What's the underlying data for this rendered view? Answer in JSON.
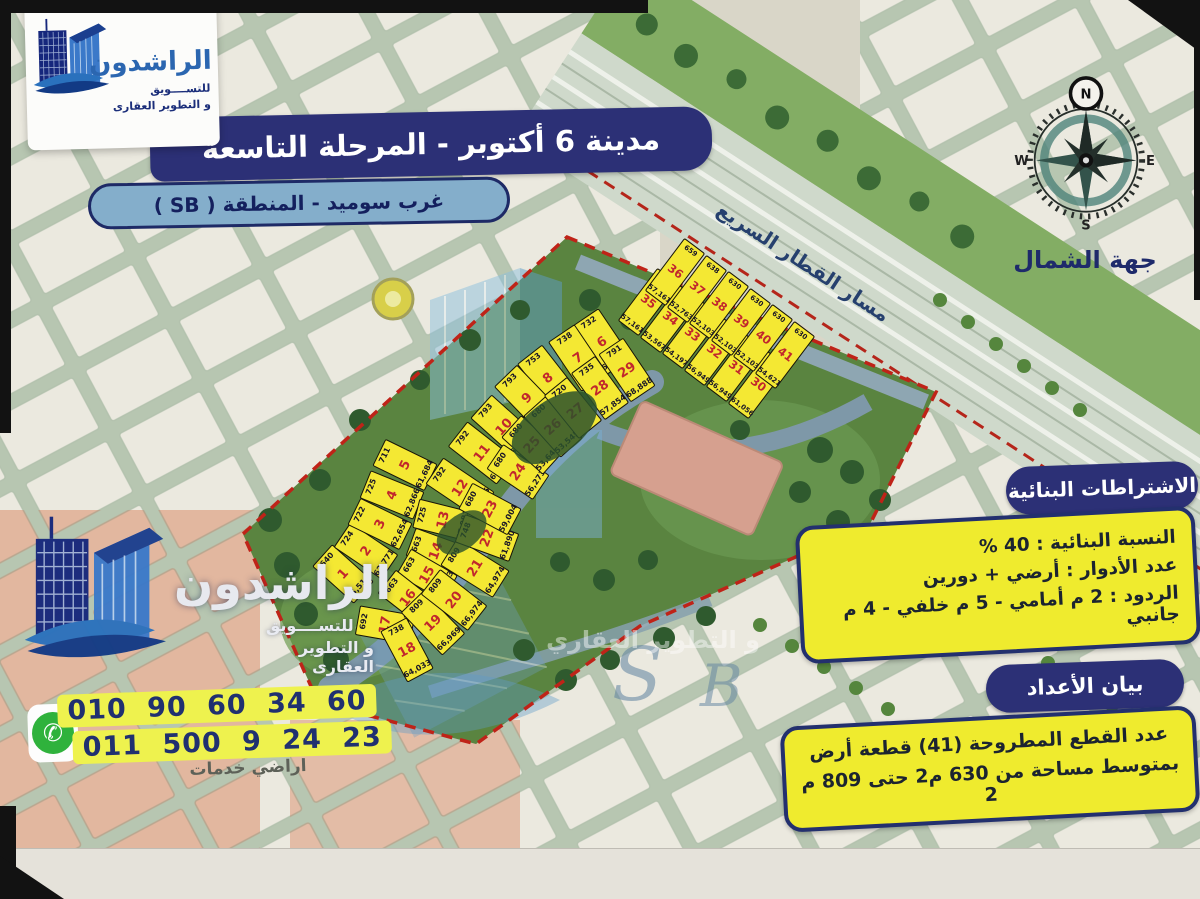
{
  "header": {
    "title": "مدينة 6 أكتوبر - المرحلة التاسعة",
    "subtitle": "غرب سوميد - المنطقة ( SB )"
  },
  "brand": {
    "name": "الراشدون",
    "tagline1": "للتســــويق",
    "tagline2": "و التطوير العقارى"
  },
  "compass": {
    "label": "جهة الشمال",
    "n": "N",
    "s": "S",
    "e": "E",
    "w": "W"
  },
  "requirements": {
    "header": "الاشتراطات البنائية",
    "lines": [
      "النسبة البنائية : 40 %",
      "عدد الأدوار :  أرضي + دورين",
      "الردود : 2 م أمامي - 5 م خلفي - 4 م جانبي"
    ]
  },
  "counts": {
    "header": "بيان الأعداد",
    "lines": [
      "عدد القطع المطروحة (41) قطعة أرض",
      "بمتوسط مساحة من 630 م2 حتى 809 م 2"
    ]
  },
  "contact": {
    "phone1": "010 90 60 34 60",
    "phone2": "011 500 9 24 23"
  },
  "map": {
    "rail_label": "مسار القطار السريع",
    "services_label": "اراضي خدمات",
    "watermark_s": "S",
    "watermark_b": "B",
    "watermark_phrase": "و التطوير العقاري",
    "plots": [
      {
        "n": "1",
        "area": "640",
        "price": "55,510",
        "x": 343,
        "y": 574,
        "r": -48,
        "w": 30,
        "h": 56,
        "g": "b"
      },
      {
        "n": "2",
        "area": "724",
        "price": "62,771",
        "x": 366,
        "y": 551,
        "r": -56,
        "w": 30,
        "h": 58,
        "g": "b"
      },
      {
        "n": "3",
        "area": "722",
        "price": "62,654",
        "x": 380,
        "y": 524,
        "r": -64,
        "w": 30,
        "h": 58,
        "g": "b"
      },
      {
        "n": "4",
        "area": "725",
        "price": "62,866",
        "x": 392,
        "y": 495,
        "r": -68,
        "w": 30,
        "h": 58,
        "g": "b"
      },
      {
        "n": "5",
        "area": "711",
        "price": "61,684",
        "x": 405,
        "y": 465,
        "r": -64,
        "w": 30,
        "h": 58,
        "g": "b"
      },
      {
        "n": "6",
        "area": "732",
        "price": "63,508",
        "x": 602,
        "y": 342,
        "r": -34,
        "w": 32,
        "h": 60,
        "g": "b"
      },
      {
        "n": "7",
        "area": "738",
        "price": "61,056",
        "x": 578,
        "y": 358,
        "r": -34,
        "w": 32,
        "h": 60,
        "g": "b"
      },
      {
        "n": "8",
        "area": "753",
        "price": "62,298",
        "x": 548,
        "y": 378,
        "r": -38,
        "w": 32,
        "h": 60,
        "g": "b"
      },
      {
        "n": "9",
        "area": "793",
        "price": "65,582",
        "x": 527,
        "y": 398,
        "r": -44,
        "w": 32,
        "h": 62,
        "g": "b"
      },
      {
        "n": "10",
        "area": "793",
        "price": "65,579",
        "x": 504,
        "y": 427,
        "r": -48,
        "w": 32,
        "h": 62,
        "g": "b"
      },
      {
        "n": "11",
        "area": "792",
        "price": "68,745",
        "x": 482,
        "y": 453,
        "r": -52,
        "w": 32,
        "h": 62,
        "g": "b"
      },
      {
        "n": "12",
        "area": "792",
        "price": "65,565",
        "x": 460,
        "y": 488,
        "r": -56,
        "w": 32,
        "h": 62,
        "g": "b"
      },
      {
        "n": "13",
        "area": "725",
        "price": "57,081",
        "x": 443,
        "y": 520,
        "r": -76,
        "w": 30,
        "h": 56,
        "g": "b"
      },
      {
        "n": "14",
        "area": "663",
        "price": "52,215",
        "x": 436,
        "y": 551,
        "r": -70,
        "w": 30,
        "h": 54,
        "g": "b"
      },
      {
        "n": "15",
        "area": "663",
        "price": "52,223",
        "x": 427,
        "y": 575,
        "r": -60,
        "w": 30,
        "h": 54,
        "g": "b"
      },
      {
        "n": "16",
        "area": "663",
        "price": "52,227",
        "x": 408,
        "y": 598,
        "r": -52,
        "w": 30,
        "h": 54,
        "g": "b"
      },
      {
        "n": "17",
        "area": "692",
        "price": "57,285",
        "x": 385,
        "y": 625,
        "r": -80,
        "w": 30,
        "h": 56,
        "g": "b"
      },
      {
        "n": "18",
        "area": "738",
        "price": "64,033",
        "x": 407,
        "y": 650,
        "r": -28,
        "w": 30,
        "h": 58,
        "g": "b"
      },
      {
        "n": "19",
        "area": "809",
        "price": "66,969",
        "x": 433,
        "y": 623,
        "r": -44,
        "w": 32,
        "h": 60,
        "g": "b"
      },
      {
        "n": "20",
        "area": "809",
        "price": "66,974",
        "x": 454,
        "y": 600,
        "r": -52,
        "w": 32,
        "h": 60,
        "g": "b"
      },
      {
        "n": "21",
        "area": "809",
        "price": "64,974",
        "x": 475,
        "y": 568,
        "r": -58,
        "w": 32,
        "h": 62,
        "g": "b"
      },
      {
        "n": "22",
        "area": "748",
        "price": "61,890",
        "x": 487,
        "y": 538,
        "r": -70,
        "w": 30,
        "h": 58,
        "g": "b"
      },
      {
        "n": "23",
        "area": "680",
        "price": "59,004",
        "x": 490,
        "y": 509,
        "r": -62,
        "w": 30,
        "h": 56,
        "g": "b"
      },
      {
        "n": "24",
        "area": "680",
        "price": "56,273",
        "x": 518,
        "y": 472,
        "r": -56,
        "w": 30,
        "h": 56,
        "g": "b"
      },
      {
        "n": "25",
        "area": "680",
        "price": "53,646",
        "x": 532,
        "y": 445,
        "r": -48,
        "w": 30,
        "h": 56,
        "g": "b"
      },
      {
        "n": "26",
        "area": "680",
        "price": "53,545",
        "x": 553,
        "y": 427,
        "r": -42,
        "w": 30,
        "h": 56,
        "g": "b"
      },
      {
        "n": "27",
        "area": "720",
        "price": "",
        "x": 573,
        "y": 408,
        "r": -39,
        "w": 30,
        "h": 56,
        "g": "b"
      },
      {
        "n": "28",
        "area": "735",
        "price": "57,854",
        "x": 600,
        "y": 388,
        "r": -36,
        "w": 30,
        "h": 58,
        "g": "b"
      },
      {
        "n": "29",
        "area": "791",
        "price": "68,888",
        "x": 627,
        "y": 370,
        "r": -34,
        "w": 30,
        "h": 58,
        "g": "b"
      },
      {
        "n": "30",
        "area": "738",
        "price": "61,056",
        "x": 758,
        "y": 385,
        "r": 37,
        "w": 26,
        "h": 66,
        "g": "a"
      },
      {
        "n": "31",
        "area": "688",
        "price": "56,949",
        "x": 736,
        "y": 368,
        "r": 37,
        "w": 26,
        "h": 66,
        "g": "a"
      },
      {
        "n": "32",
        "area": "688",
        "price": "56,949",
        "x": 714,
        "y": 352,
        "r": 37,
        "w": 26,
        "h": 66,
        "g": "a"
      },
      {
        "n": "33",
        "area": "688",
        "price": "54,197",
        "x": 692,
        "y": 335,
        "r": 37,
        "w": 26,
        "h": 66,
        "g": "a"
      },
      {
        "n": "34",
        "area": "680",
        "price": "53,567",
        "x": 670,
        "y": 319,
        "r": 37,
        "w": 26,
        "h": 66,
        "g": "a"
      },
      {
        "n": "35",
        "area": "659",
        "price": "57,161",
        "x": 648,
        "y": 302,
        "r": 37,
        "w": 26,
        "h": 66,
        "g": "a"
      },
      {
        "n": "36",
        "area": "659",
        "price": "57,161",
        "x": 675,
        "y": 272,
        "r": 37,
        "w": 26,
        "h": 66,
        "g": "a"
      },
      {
        "n": "37",
        "area": "638",
        "price": "52,763",
        "x": 697,
        "y": 289,
        "r": 37,
        "w": 26,
        "h": 66,
        "g": "a"
      },
      {
        "n": "38",
        "area": "630",
        "price": "52,103",
        "x": 719,
        "y": 305,
        "r": 37,
        "w": 26,
        "h": 66,
        "g": "a"
      },
      {
        "n": "39",
        "area": "630",
        "price": "52,103",
        "x": 741,
        "y": 322,
        "r": 37,
        "w": 26,
        "h": 66,
        "g": "a"
      },
      {
        "n": "40",
        "area": "630",
        "price": "52,103",
        "x": 763,
        "y": 338,
        "r": 37,
        "w": 26,
        "h": 66,
        "g": "a"
      },
      {
        "n": "41",
        "area": "630",
        "price": "54,621",
        "x": 785,
        "y": 355,
        "r": 37,
        "w": 26,
        "h": 66,
        "g": "a"
      }
    ]
  },
  "colors": {
    "navy": "#2c3076",
    "steel_blue": "#84aecb",
    "info_yellow": "#efeb2e",
    "plot_yellow": "#f4e833",
    "plot_number_red": "#c1272d",
    "boundary_red": "#bf2318",
    "whatsapp_green": "#2fb23c",
    "dev_green": "#5a8440"
  }
}
